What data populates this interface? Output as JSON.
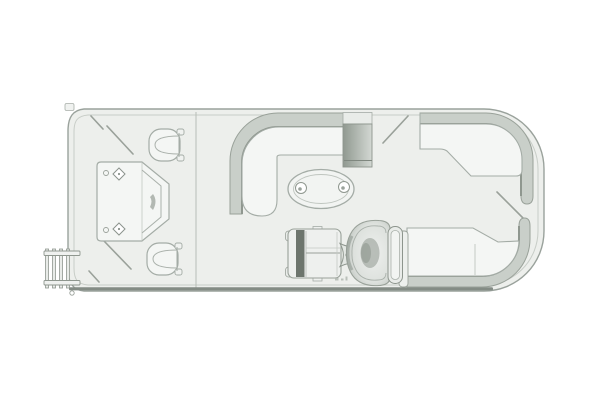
{
  "figure": {
    "kind": "pontoon-boat-floor-plan",
    "view": "top-down line drawing, bow at left, stern at right",
    "background": "#ffffff"
  },
  "colors": {
    "deck_fill": "#edefec",
    "hull_stroke": "#9aa29c",
    "inner_line": "#c3c9c3",
    "furniture_fill": "#f4f6f4",
    "furniture_stroke": "#a4aca6",
    "band_fill": "#c9cfc9",
    "band_dark": "#8f978f",
    "shadow_dark": "#848c85",
    "dark_block_start": "#909990",
    "dark_block_end": "#d3d8d3",
    "console_dark": "#6d756d",
    "detail_gray": "#9aa19a"
  },
  "parts": {
    "hull": "pontoon deck outline with rub rail",
    "boarding_ladder": "bow boarding ladder (port bow, left edge)",
    "bow_lounge": "angled bow sun lounge with diamond fittings",
    "swivel_chair_top": "forward bucket chair, top side",
    "swivel_chair_bottom": "forward bucket chair, bottom side",
    "midship_l_lounge": "L-shaped lounge along top midship",
    "cocktail_table": "oval cocktail table with two cup holders",
    "shaded_seat_block": "dark upholstered seat section, top side",
    "aft_corner_lounge_top": "J-shaped lounge wrapping top stern corner",
    "stern_lounge_bottom": "L-shaped lounge wrapping bottom stern corner",
    "helm_console": "helm console with windscreen band",
    "steering_wheel": "steering wheel between console and seat",
    "captains_chair": "captain's chair with headrest bar",
    "gate_lines": "diagonal boarding gate swing lines (bow and stern)"
  }
}
